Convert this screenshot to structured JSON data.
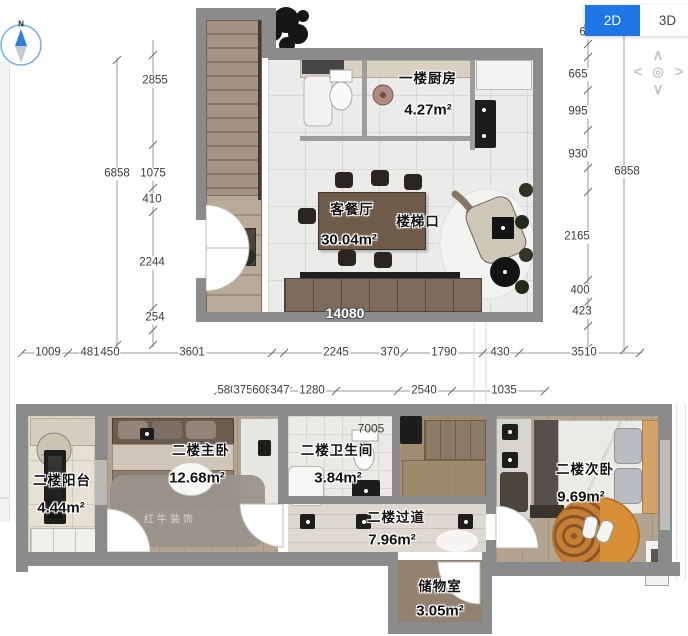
{
  "header": {
    "view_toggle": {
      "selected": "2D",
      "options": {
        "d2": "2D",
        "d3": "3D"
      }
    }
  },
  "compass": {
    "north_label": "N"
  },
  "pan": {
    "up": "∧",
    "down": "∨",
    "left": "<",
    "right": ">",
    "center": "◎"
  },
  "floor1": {
    "rooms": {
      "kitchen": {
        "name": "一楼厨房",
        "area": "4.27m²"
      },
      "living_dining": {
        "name": "客餐厅",
        "area": "30.04m²"
      },
      "stair_landing": {
        "name": "楼梯口"
      }
    },
    "bottom_width_label": "14080"
  },
  "floor2": {
    "rooms": {
      "balcony": {
        "name": "二楼阳台",
        "area": "4.44m²"
      },
      "master_bedroom": {
        "name": "二楼主卧",
        "area": "12.68m²"
      },
      "bathroom": {
        "name": "二楼卫生间",
        "area": "3.84m²"
      },
      "hallway": {
        "name": "二楼过道",
        "area": "7.96m²"
      },
      "second_bedroom": {
        "name": "二楼次卧",
        "area": "9.69m²"
      },
      "storage": {
        "name": "储物室",
        "area": "3.05m²"
      }
    },
    "top_dim": "7005",
    "watermark": "红牛装饰"
  },
  "dimensions": {
    "left_outer": "6858",
    "left_inner": [
      "2855",
      "1075",
      "410",
      "2244",
      "254"
    ],
    "right_outer": "6858",
    "right_inner": [
      "633",
      "665",
      "995",
      "930",
      "2165",
      "400",
      "423"
    ],
    "bottom_row1": [
      "1009",
      "481",
      "450",
      "3601",
      "2245",
      "370",
      "1790",
      "430",
      "3510"
    ],
    "bottom_row2": [
      "580",
      "375",
      "608",
      "347",
      "1280",
      "2540",
      "1035"
    ]
  },
  "colors": {
    "accent_blue": "#1f77e6",
    "wall_gray": "#8b8b8b"
  }
}
